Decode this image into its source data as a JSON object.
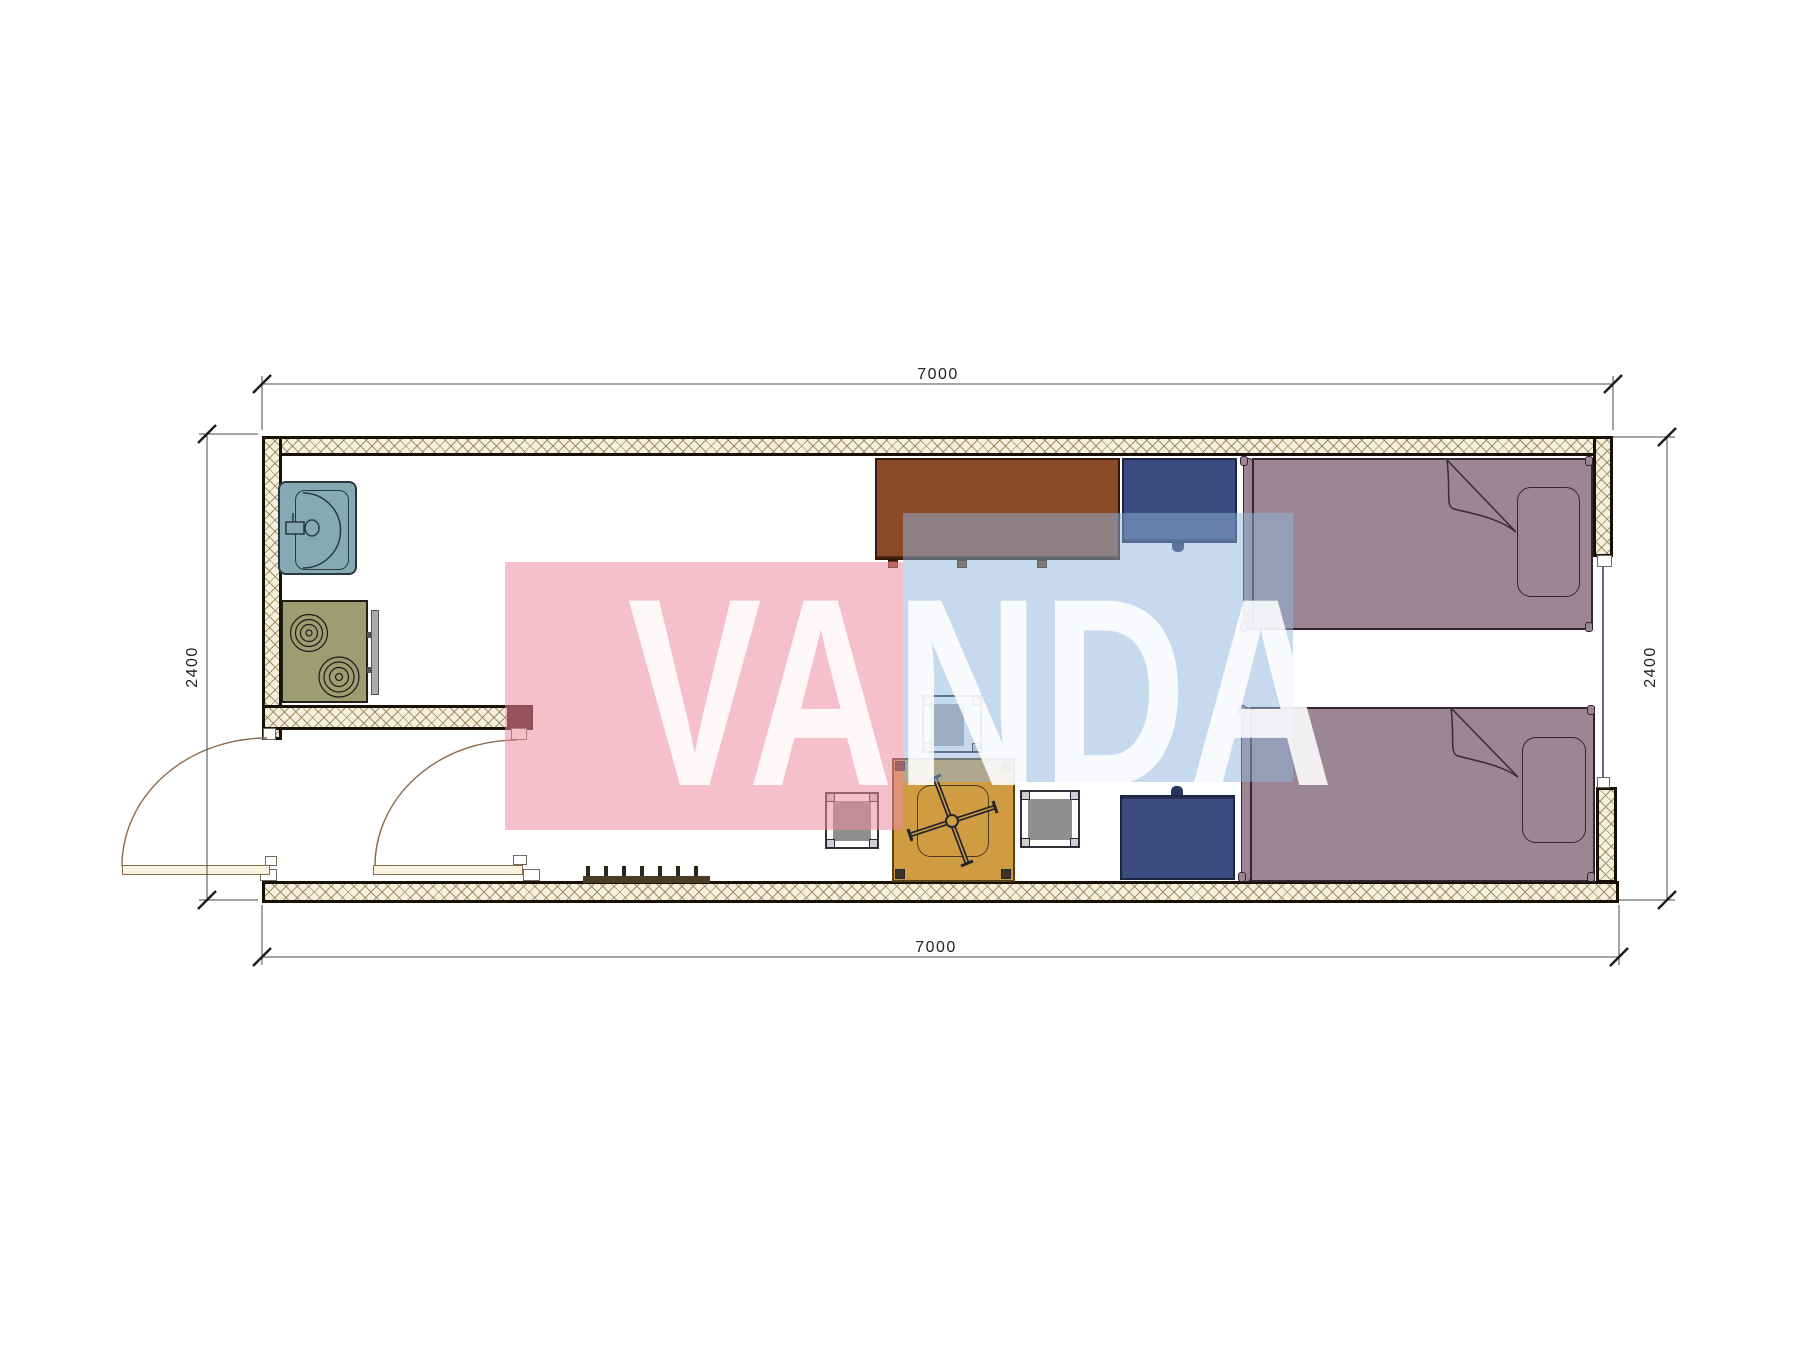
{
  "watermark": {
    "text": "VANDA",
    "pink_color": "#ee8aa2",
    "blue_color": "#8fb3dc"
  },
  "dimensions": {
    "top": "7000",
    "bottom": "7000",
    "left": "2400",
    "right": "2400"
  },
  "palette": {
    "wall_fill": "#f6efdc",
    "wall_line": "#191106",
    "partition_cap": "#2e0f0b",
    "sink": "#86a9b4",
    "stove": "#9d9d72",
    "stove_panel": "#ababab",
    "desk": "#8a4a28",
    "nightstand": "#3d4c80",
    "cabinet": "#3d4c80",
    "bed": "#9d8693",
    "table": "#cf9c42",
    "stool_seat": "#8f8f8f",
    "stool_seat_light": "#a8a8a8",
    "door_leaf": "#faf3e0",
    "radiator": "#4a3b27",
    "dimension_line": "#4a4a4a"
  }
}
